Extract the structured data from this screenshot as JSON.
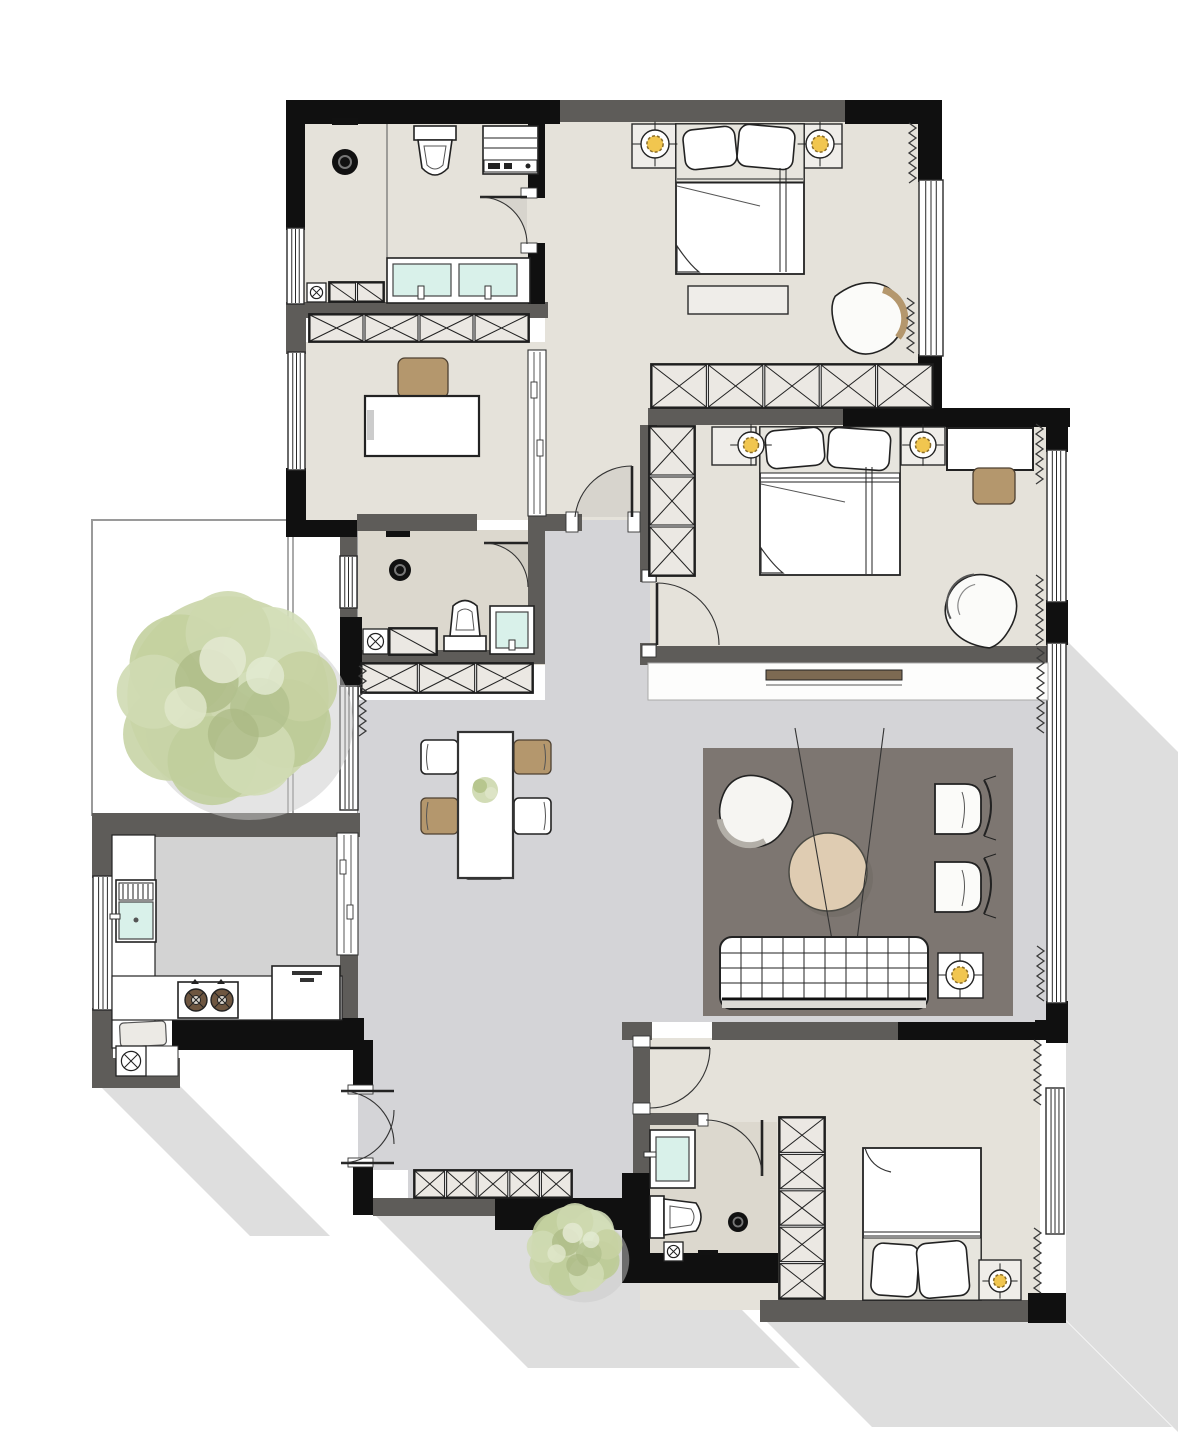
{
  "document": {
    "title": "Apartment floor plan — top-down furnished rendering",
    "type": "floor-plan"
  },
  "colors": {
    "wall_black": "#101010",
    "wall_gray": "#5e5c59",
    "floor_beige": "#e5e2da",
    "floor_bath": "#dcd8ce",
    "floor_gray": "#d4d4d7",
    "floor_kitchen": "#d3d3d3",
    "counter": "#ffffff",
    "rug": "#7d7671",
    "wood": "#b4976d",
    "table_tan": "#dfccb2",
    "sink": "#d9f1ea",
    "lamp": "#f1c64f",
    "hatch": "#ebe8e3",
    "tree": "#c9d5a8",
    "shadow": "#d8d8d8",
    "line": "#1f1f1f"
  },
  "rooms": [
    {
      "id": "bathroom-top",
      "label": "bathroom with shower, toilet, washer, double vanity"
    },
    {
      "id": "corridor",
      "label": "suite corridor"
    },
    {
      "id": "bedroom-top-right",
      "label": "bedroom with double bed, bench, armchair"
    },
    {
      "id": "study",
      "label": "study with desk and chair"
    },
    {
      "id": "bathroom-middle",
      "label": "guest bathroom"
    },
    {
      "id": "bedroom-middle-right",
      "label": "bedroom with desk and armchair"
    },
    {
      "id": "living-room",
      "label": "living room with rug, sofa, coffee table"
    },
    {
      "id": "dining-area",
      "label": "dining table for five"
    },
    {
      "id": "kitchen",
      "label": "L-shaped kitchen"
    },
    {
      "id": "entry-hall",
      "label": "entry hall with shoe cabinet"
    },
    {
      "id": "master-bedroom",
      "label": "bedroom with wardrobe column"
    },
    {
      "id": "ensuite-bathroom",
      "label": "en-suite bathroom"
    },
    {
      "id": "terrace",
      "label": "outdoor terrace with tree"
    }
  ],
  "legend": {
    "x_hatch_box": "wardrobe / storage cabinet",
    "diag_box": "low cabinet",
    "circle_cross_yellow": "lamp",
    "circle_black": "floor drain",
    "box_circle_x": "floor vent",
    "zigzag": "curtain",
    "quarter_arc": "door swing",
    "double_line_band": "window glazing",
    "grid_rect": "sofa",
    "green_blob": "tree / plant"
  },
  "windows": [
    {
      "x": 287,
      "y": 228,
      "w": 17,
      "h": 76
    },
    {
      "x": 288,
      "y": 352,
      "w": 17,
      "h": 118
    },
    {
      "x": 93,
      "y": 876,
      "w": 20,
      "h": 134
    },
    {
      "x": 340,
      "y": 556,
      "w": 17,
      "h": 52
    },
    {
      "x": 340,
      "y": 686,
      "w": 18,
      "h": 124
    },
    {
      "x": 919,
      "y": 180,
      "w": 24,
      "h": 176
    },
    {
      "x": 1047,
      "y": 450,
      "w": 19,
      "h": 152
    },
    {
      "x": 1047,
      "y": 643,
      "w": 19,
      "h": 360
    },
    {
      "x": 1046,
      "y": 1088,
      "w": 18,
      "h": 146
    }
  ],
  "cabinets": [
    {
      "x": 309,
      "y": 314,
      "w": 220,
      "h": 28,
      "cells": 4,
      "dir": "h",
      "type": "x"
    },
    {
      "x": 361,
      "y": 663,
      "w": 172,
      "h": 30,
      "cells": 3,
      "dir": "h",
      "type": "x"
    },
    {
      "x": 651,
      "y": 364,
      "w": 282,
      "h": 44,
      "cells": 5,
      "dir": "h",
      "type": "x"
    },
    {
      "x": 649,
      "y": 426,
      "w": 46,
      "h": 150,
      "cells": 3,
      "dir": "v",
      "type": "x"
    },
    {
      "x": 963,
      "y": 664,
      "w": 73,
      "h": 30,
      "cells": 2,
      "dir": "h",
      "type": "x"
    },
    {
      "x": 414,
      "y": 1170,
      "w": 158,
      "h": 28,
      "cells": 5,
      "dir": "h",
      "type": "x"
    },
    {
      "x": 779,
      "y": 1117,
      "w": 46,
      "h": 182,
      "cells": 5,
      "dir": "v",
      "type": "x"
    },
    {
      "x": 329,
      "y": 282,
      "w": 55,
      "h": 20,
      "cells": 2,
      "dir": "h",
      "type": "diag"
    },
    {
      "x": 389,
      "y": 628,
      "w": 48,
      "h": 27,
      "cells": 1,
      "dir": "h",
      "type": "diag"
    }
  ],
  "curtains": [
    {
      "x": 909,
      "y": 123,
      "len": 58
    },
    {
      "x": 907,
      "y": 298,
      "len": 56
    },
    {
      "x": 1036,
      "y": 424,
      "len": 60
    },
    {
      "x": 1036,
      "y": 575,
      "len": 72
    },
    {
      "x": 1037,
      "y": 648,
      "len": 85
    },
    {
      "x": 1037,
      "y": 946,
      "len": 56
    },
    {
      "x": 1034,
      "y": 1040,
      "len": 66
    },
    {
      "x": 1034,
      "y": 1228,
      "len": 66
    },
    {
      "x": 359,
      "y": 666,
      "len": 68
    }
  ],
  "vents": [
    {
      "x": 307,
      "y": 283,
      "s": 19
    },
    {
      "x": 363,
      "y": 629,
      "s": 25
    },
    {
      "x": 116,
      "y": 1046,
      "s": 30
    },
    {
      "x": 664,
      "y": 1242,
      "s": 19
    }
  ],
  "lamps": [
    {
      "cx": 655,
      "cy": 144,
      "r": 14
    },
    {
      "cx": 820,
      "cy": 144,
      "r": 14
    },
    {
      "cx": 751,
      "cy": 445,
      "r": 13
    },
    {
      "cx": 923,
      "cy": 445,
      "r": 13
    },
    {
      "cx": 960,
      "cy": 975,
      "r": 14
    },
    {
      "cx": 1000,
      "cy": 1281,
      "r": 11
    }
  ]
}
